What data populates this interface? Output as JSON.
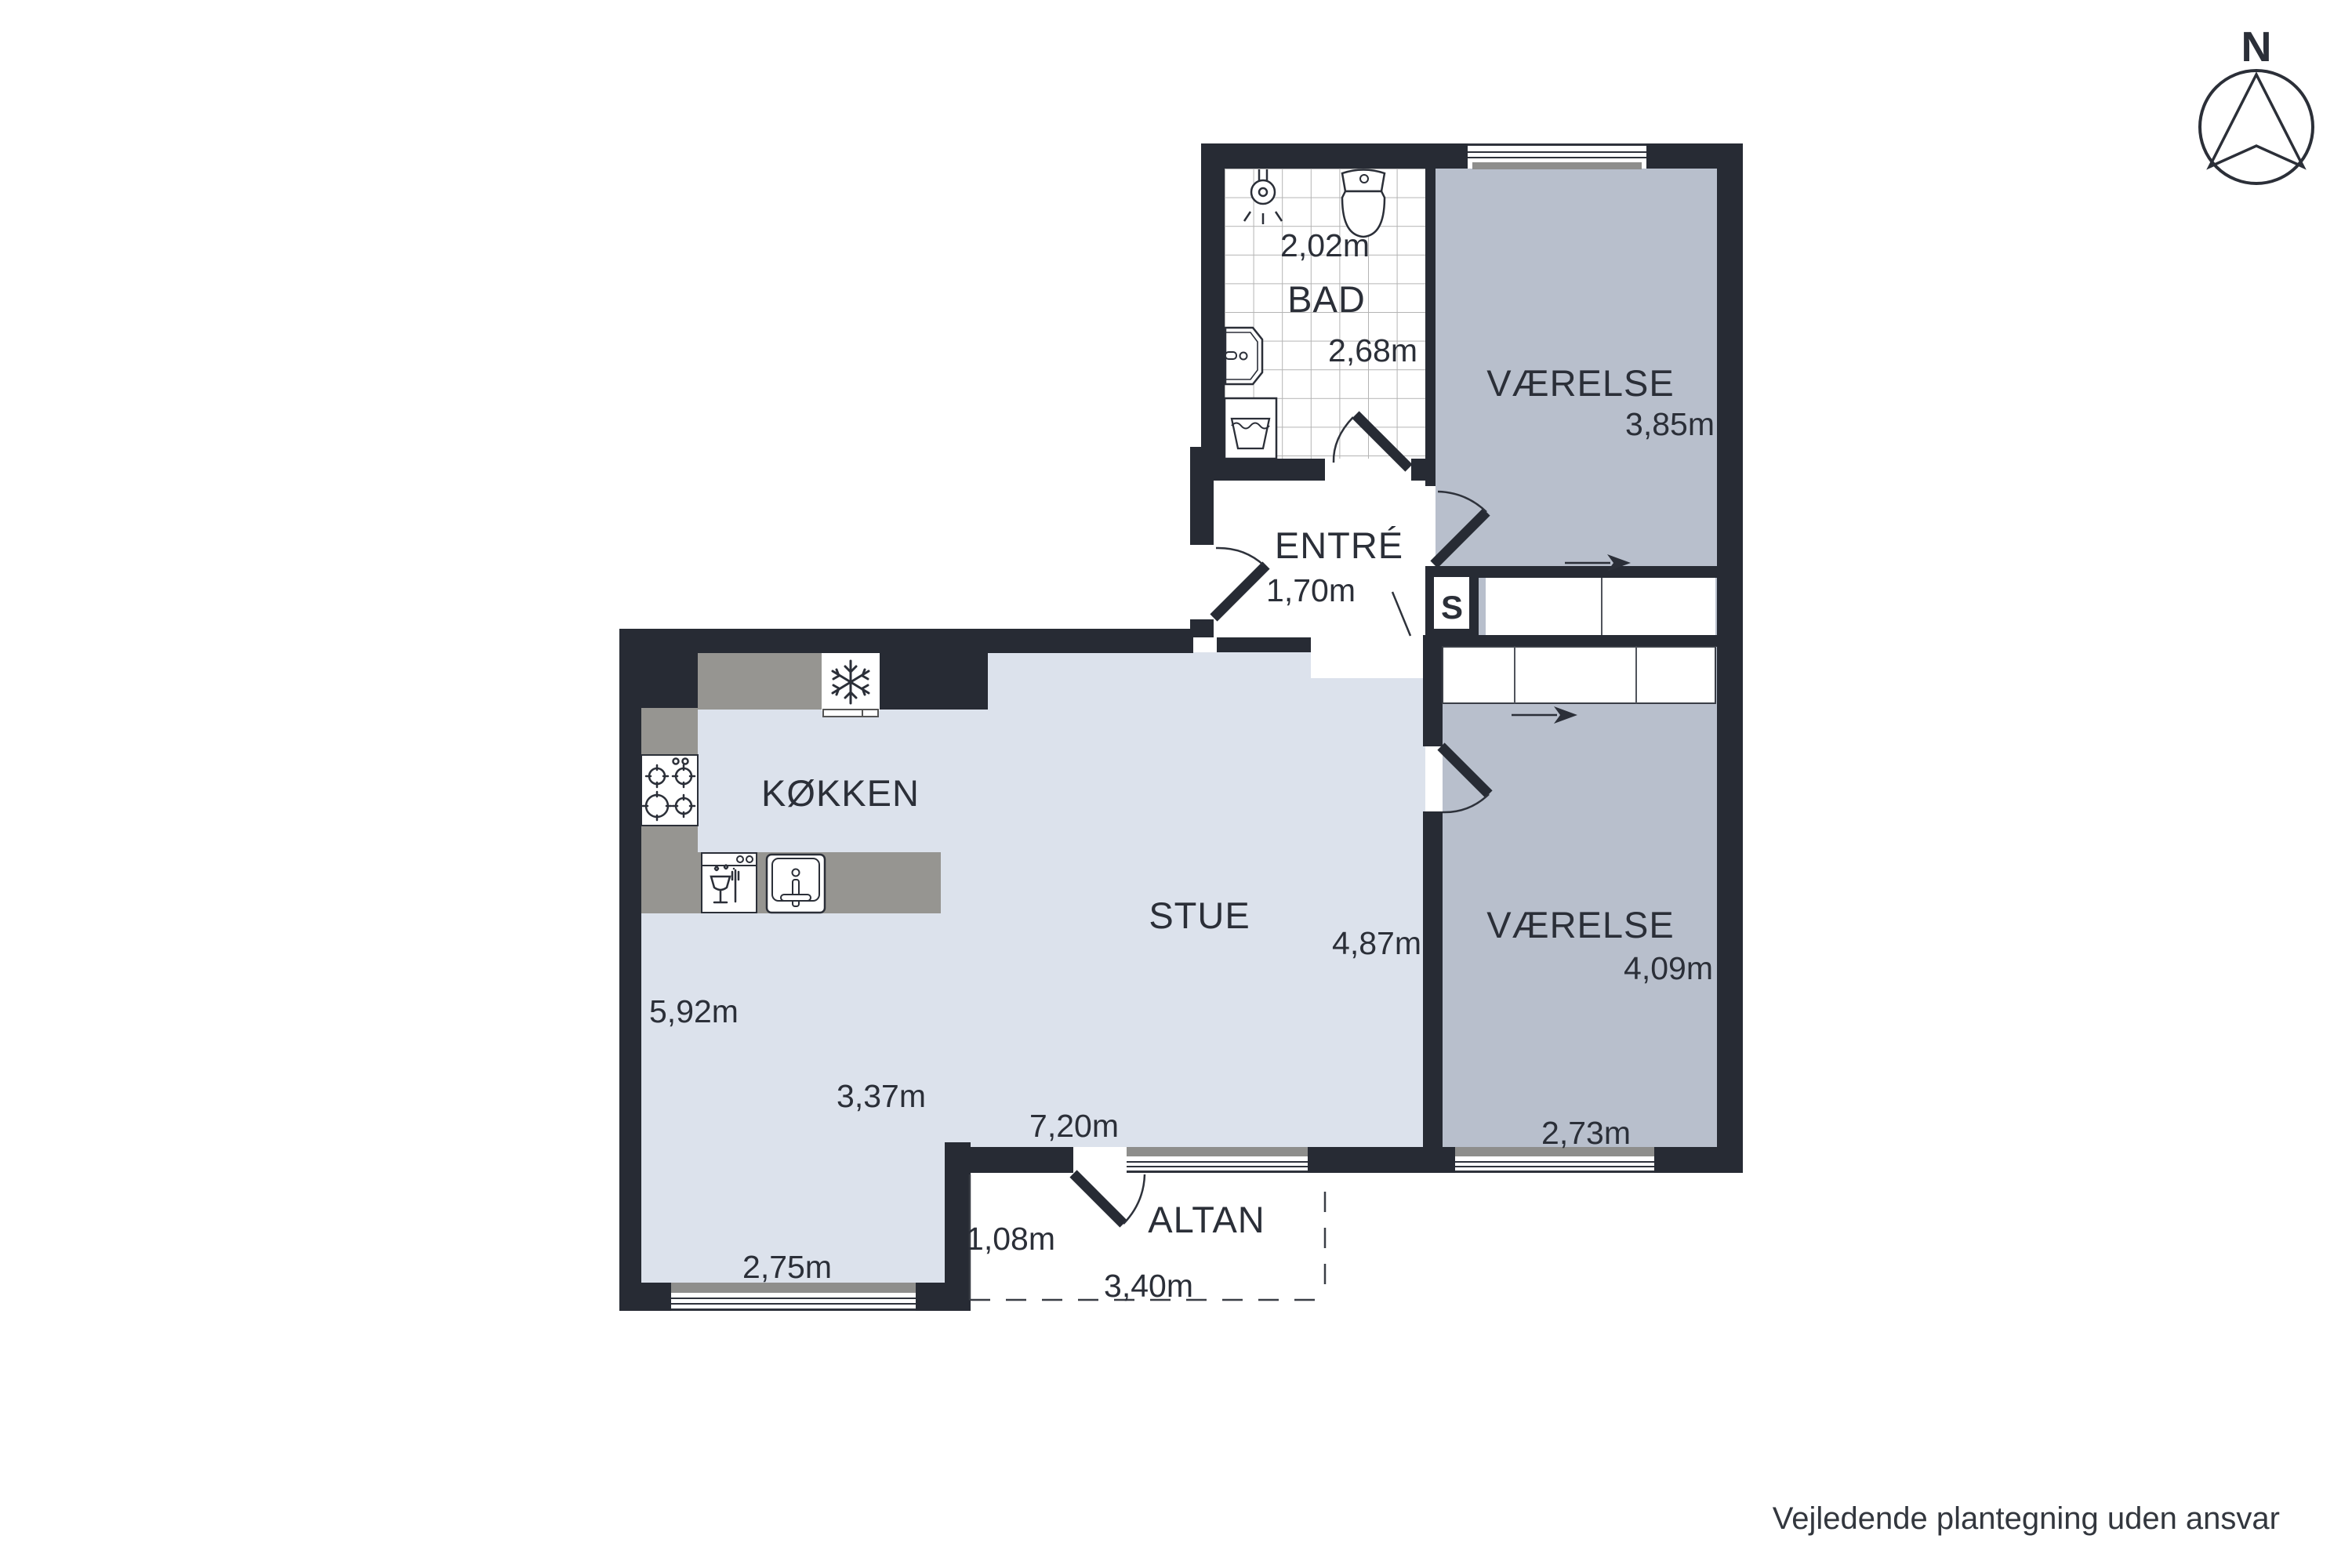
{
  "compass": {
    "north_label": "N"
  },
  "rooms": {
    "bad": {
      "label": "BAD",
      "width": "2,02m",
      "depth": "2,68m"
    },
    "vaerelse1": {
      "label": "VÆRELSE",
      "depth": "3,85m"
    },
    "entre": {
      "label": "ENTRÉ",
      "width": "1,70m"
    },
    "closet": {
      "label": "S"
    },
    "koekken": {
      "label": "KØKKEN",
      "depth": "5,92m",
      "window_width": "2,75m"
    },
    "stue": {
      "label": "STUE",
      "depth": "4,87m",
      "width_part": "3,37m",
      "width_total": "7,20m"
    },
    "vaerelse2": {
      "label": "VÆRELSE",
      "depth": "4,09m",
      "window_width": "2,73m"
    },
    "altan": {
      "label": "ALTAN",
      "door_width": "1,08m",
      "width": "3,40m"
    }
  },
  "footer": {
    "disclaimer": "Vejledende plantegning uden ansvar"
  },
  "colors": {
    "wall": "#272b34",
    "floor_light": "#dce2ec",
    "floor_room": "#b8bfcc",
    "counter": "#969591",
    "sill": "#8e8e8c"
  }
}
